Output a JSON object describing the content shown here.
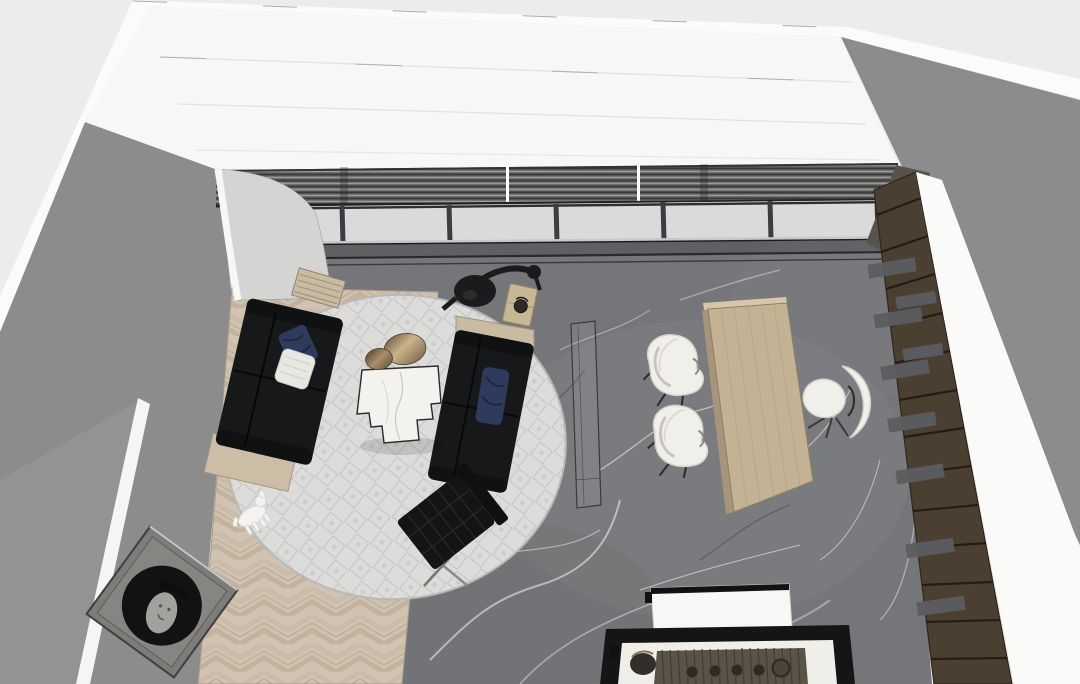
{
  "scene": {
    "viewport_label": "3D interior model — top-down view of furnished lounge and office room",
    "objects": [
      "left-wall",
      "back-wall",
      "right-wall",
      "window-band-with-blinds",
      "curved-wall-panel",
      "gray-marble-floor",
      "herringbone-wood-floor",
      "round-area-rug",
      "black-sofa-left",
      "black-sofa-right",
      "marble-coffee-table",
      "bronze-disc-tables",
      "black-floor-lamp",
      "wood-side-table",
      "slatted-wood-bench",
      "barcelona-chair",
      "balloon-dog-sculpture",
      "glass-console",
      "wood-desk",
      "white-guest-chair",
      "white-guest-chair",
      "white-office-chair",
      "dark-wood-bookshelf",
      "white-bench",
      "black-frame-display-table",
      "leaning-circle-artwork"
    ]
  },
  "palette": {
    "bg": "#ECECEA",
    "wall_white": "#FBFBF9",
    "wall_gray": "#8C8C8C",
    "wall_gray_outer": "#939393",
    "back_wall": "#F7F7F5",
    "curved_wall": "#D4D4D2",
    "glass": "#D9DBDB",
    "mullion": "#3B3D40",
    "marble_floor": "#75767A",
    "rug_base": "#DCDCDA",
    "wood_floor": "#D0C3B1",
    "sofa_black": "#17181A",
    "pillow_blue": "#2F3B5D",
    "pillow_white": "#E9E7E2",
    "console_wood": "#C9BBA2",
    "coffee_marble": "#F3F2EF",
    "desk_wood": "#C4B294",
    "chair_white": "#F1EFEA",
    "bookshelf_wood": "#4B3F32",
    "shelf_slot_gray": "#5B5D61",
    "bench_white": "#F8F7F5",
    "table_frame": "#151515",
    "table_top": "#EFEEE9",
    "runner_dark": "#5A5347",
    "frame_gray": "#7C7C7A",
    "art_black": "#111214",
    "dog_white": "#F4F3F1",
    "lamp_black": "#1B1B1D"
  }
}
